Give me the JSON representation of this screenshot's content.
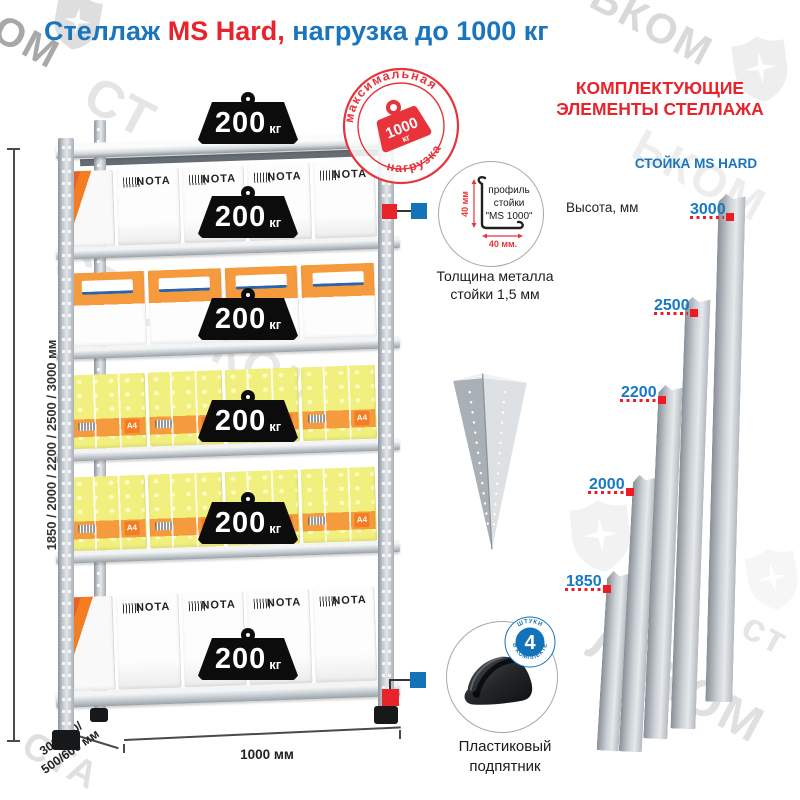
{
  "title": {
    "word_blue1": "Стеллаж",
    "word_red": "MS Hard,",
    "word_blue2": "нагрузка до 1000 кг"
  },
  "stamp": {
    "arc_top": "максимальная",
    "arc_bottom": "нагрузка",
    "weight_value": "1000",
    "weight_unit": "кг"
  },
  "rack": {
    "box_brand": "NOTA",
    "paper_label": "A4",
    "weights": [
      {
        "value": "200",
        "unit": "кг"
      },
      {
        "value": "200",
        "unit": "кг"
      },
      {
        "value": "200",
        "unit": "кг"
      },
      {
        "value": "200",
        "unit": "кг"
      },
      {
        "value": "200",
        "unit": "кг"
      },
      {
        "value": "200",
        "unit": "кг"
      }
    ],
    "dim_height": "1850 / 2000 / 2200 / 2500 / 3000 мм",
    "dim_depth_line1": "300/400/",
    "dim_depth_line2": "500/600 мм",
    "dim_width": "1000 мм"
  },
  "profile_detail": {
    "line1": "профиль",
    "line2": "стойки",
    "line3": "\"MS 1000\"",
    "dim_vertical": "40 мм",
    "dim_horizontal": "40 мм.",
    "caption_line1": "Толщина металла",
    "caption_line2": "стойки 1,5 мм"
  },
  "foot_detail": {
    "badge_number": "4",
    "badge_text_top": "штуки",
    "badge_text_bottom": "в комплекте",
    "caption_line1": "Пластиковый",
    "caption_line2": "подпятник"
  },
  "components": {
    "header_line1": "КОМПЛЕКТУЮЩИЕ",
    "header_line2": "ЭЛЕМЕНТЫ СТЕЛЛАЖА",
    "subheader": "СТОЙКА MS HARD",
    "height_label": "Высота, мм",
    "post_heights": [
      "3000",
      "2500",
      "2200",
      "2000",
      "1850"
    ]
  },
  "watermark": {
    "brand": "СТАЛЬКОМ",
    "fragments": [
      "ОМ",
      "ЬКОМ",
      "СТ",
      "СТАЛЬКОМ",
      "ЛЬКОМ",
      "СТА",
      "ст"
    ]
  }
}
